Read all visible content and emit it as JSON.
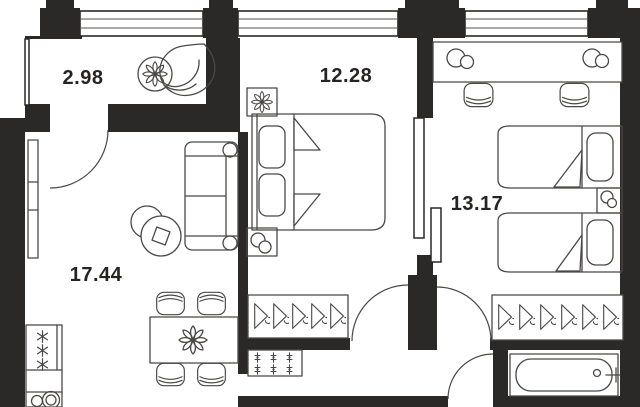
{
  "plan": {
    "type": "apartment-floor-plan",
    "rooms": [
      {
        "name": "balcony",
        "area": "2.98"
      },
      {
        "name": "bedroom",
        "area": "12.28"
      },
      {
        "name": "kids-bedroom",
        "area": "13.17"
      },
      {
        "name": "kitchen-living-room",
        "area": "17.44"
      }
    ],
    "colors": {
      "wall": "#2b2927",
      "furniture_line": "#4a4846",
      "background": "#ffffff",
      "label_text": "#262422"
    },
    "icons": [
      "flower-icon",
      "hanger-icon",
      "burner-icon",
      "vent-plus-icon",
      "lamp-circles-icon"
    ]
  }
}
